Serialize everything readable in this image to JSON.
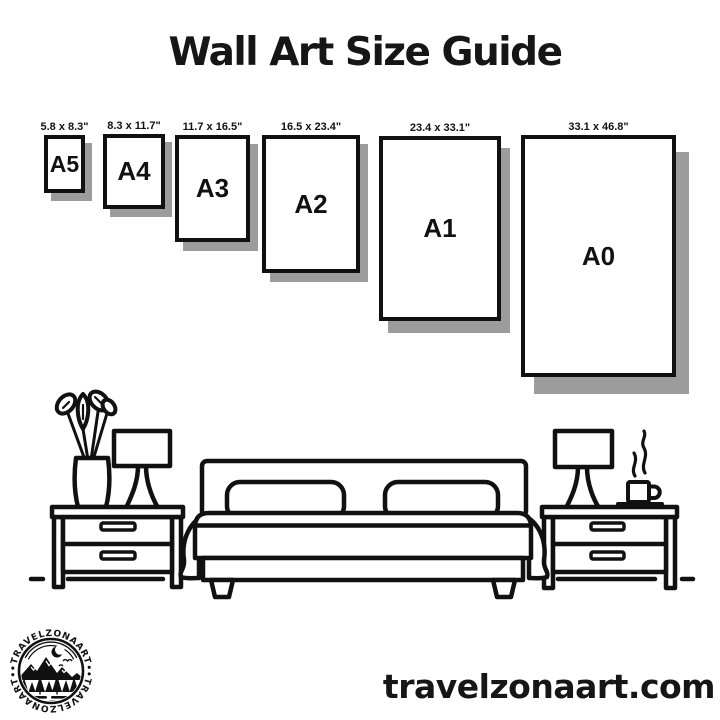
{
  "title": "Wall Art Size Guide",
  "sizes": [
    {
      "name": "A5",
      "dimensions": "5.8 x 8.3\""
    },
    {
      "name": "A4",
      "dimensions": "8.3 x 11.7\""
    },
    {
      "name": "A3",
      "dimensions": "11.7 x 16.5\""
    },
    {
      "name": "A2",
      "dimensions": "16.5 x 23.4\""
    },
    {
      "name": "A1",
      "dimensions": "23.4 x 33.1\""
    },
    {
      "name": "A0",
      "dimensions": "33.1 x 46.8\""
    }
  ],
  "logo": {
    "arc_top": "•TRAVELZONAART•",
    "arc_bottom": "•TRAVELZONAART•"
  },
  "website": "travelzonaart.com",
  "colors": {
    "ink": "#111111",
    "shadow": "#9c9c9c",
    "background": "#ffffff"
  }
}
